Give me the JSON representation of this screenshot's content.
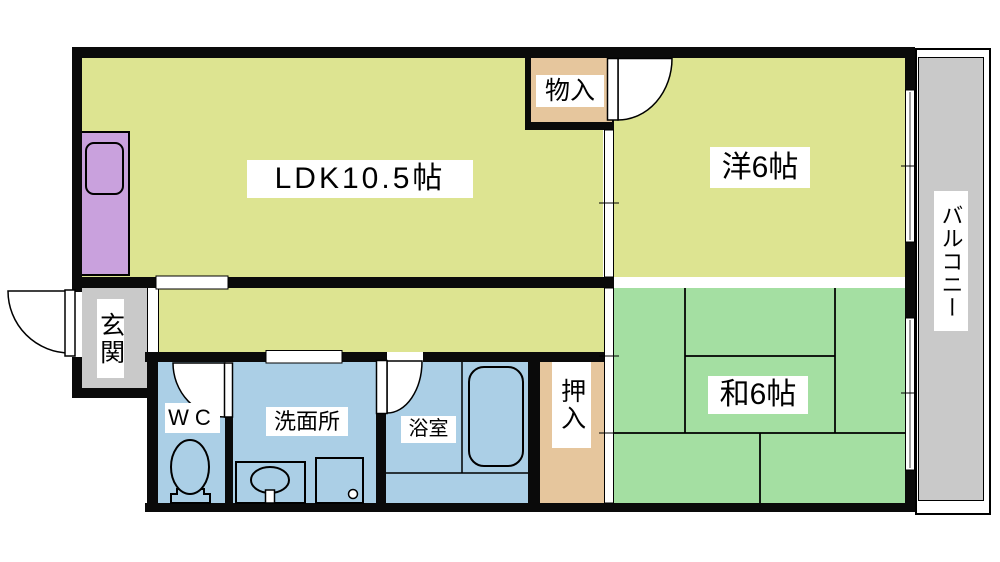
{
  "plan": {
    "rooms": {
      "ldk": {
        "label": "LDK10.5帖"
      },
      "western": {
        "label": "洋6帖"
      },
      "japanese": {
        "label": "和6帖"
      },
      "storage": {
        "label": "物入"
      },
      "closet": {
        "label": "押入"
      },
      "entrance": {
        "label": "玄関"
      },
      "balcony": {
        "label": "バルコニー"
      },
      "wc": {
        "label": "WC"
      },
      "washroom": {
        "label": "洗面所"
      },
      "bathroom": {
        "label": "浴室"
      }
    },
    "colors": {
      "room_yellow": "#dde491",
      "tatami_green": "#a4dfa2",
      "wet_blue": "#abcfe6",
      "closet_tan": "#e6c69d",
      "kitchen_purple": "#c9a1dd",
      "gray": "#c9c9c9",
      "wall_black": "#0a0a0a",
      "label_bg": "#ffffff",
      "label_text": "#000000"
    }
  }
}
